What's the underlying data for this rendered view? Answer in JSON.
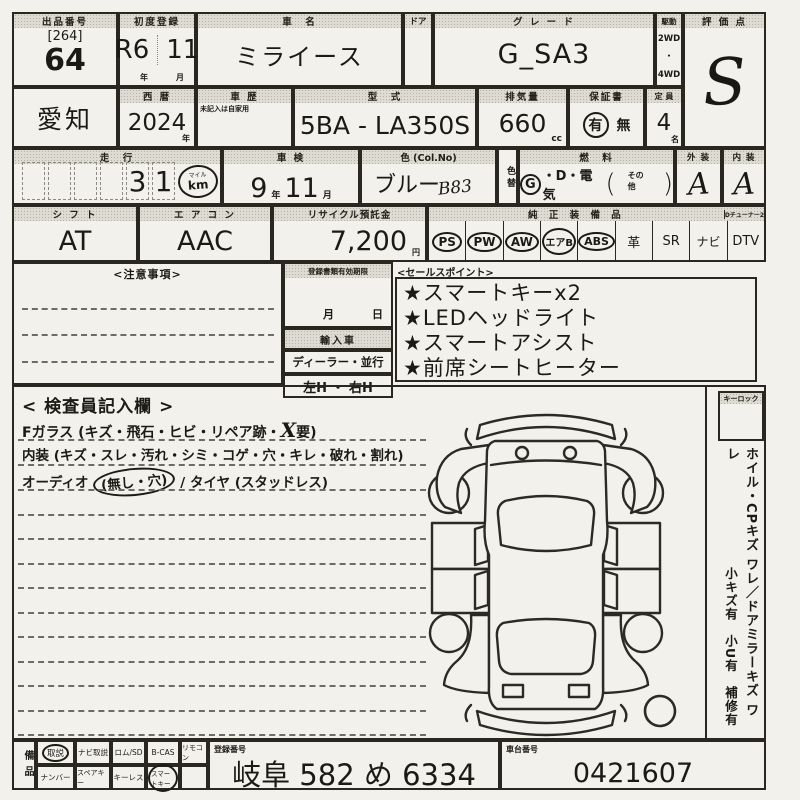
{
  "row1": {
    "lot_header": "出品番号",
    "lot_bracket": "[264]",
    "lot_number": "64",
    "first_reg_header": "初度登録",
    "first_reg_era": "R6",
    "first_reg_month": "11",
    "first_reg_year_unit": "年",
    "first_reg_month_unit": "月",
    "car_name_header": "車　名",
    "car_name": "ミライース",
    "door_header": "ドア",
    "grade_header": "グ レ ー ド",
    "grade": "G_SA3",
    "drive_header": "駆動",
    "drive_2wd": "2WD",
    "drive_dot": "・",
    "drive_4wd": "4WD",
    "score_header": "評 価 点",
    "score": "S"
  },
  "row2": {
    "region": "愛知",
    "year_header": "西 暦",
    "year": "2024",
    "year_unit": "年",
    "history_header": "車 歴",
    "history_note": "未記入は自家用",
    "model_header": "型　式",
    "model": "5BA - LA350S",
    "displacement_header": "排気量",
    "displacement": "660",
    "displacement_unit": "cc",
    "warranty_header": "保証書",
    "warranty_yes": "有",
    "warranty_no": "無",
    "capacity_header": "定 員",
    "capacity": "4",
    "capacity_unit": "名"
  },
  "row3": {
    "mileage_header": "走　行",
    "mileage_d1": "3",
    "mileage_d2": "1",
    "mileage_mile": "マイル",
    "mileage_km": "km",
    "inspection_header": "車 検",
    "inspection_year": "9",
    "inspection_year_unit": "年",
    "inspection_month": "11",
    "inspection_month_unit": "月",
    "color_header": "色 (Col.No)",
    "color": "ブルー",
    "color_code": "B83",
    "color_change": "色替",
    "fuel_header": "燃　料",
    "fuel_g": "G",
    "fuel_rest": "・D・電気",
    "fuel_paren_open": "(",
    "fuel_other": "その他",
    "fuel_paren_close": ")",
    "exterior_header": "外 装",
    "exterior": "A",
    "interior_header": "内 装",
    "interior": "A"
  },
  "row4": {
    "shift_header": "シ フ ト",
    "shift": "AT",
    "aircon_header": "エ ア コ ン",
    "aircon": "AAC",
    "recycle_header": "リサイクル預託金",
    "recycle": "7,200",
    "recycle_unit": "円",
    "equip_header": "純 正 装 備 品",
    "dtv_header": "Dチューナー2",
    "equip": [
      {
        "label": "PS"
      },
      {
        "label": "PW"
      },
      {
        "label": "AW"
      },
      {
        "label": "エアB"
      },
      {
        "label": "ABS"
      },
      {
        "label": "革"
      },
      {
        "label": "SR"
      },
      {
        "label": "ナビ"
      },
      {
        "label": "DTV"
      }
    ]
  },
  "notes": {
    "title": "<注意事項>"
  },
  "docs": {
    "validity_header": "登録書類有効期限",
    "month_unit": "月",
    "day_unit": "日",
    "import_header": "輸入車",
    "dealer": "ディーラー・並行",
    "handle": "左H ・ 右H"
  },
  "sales": {
    "title": "<セールスポイント>",
    "points": [
      "★スマートキーx2",
      "★LEDヘッドライト",
      "★スマートアシスト",
      "★前席シートヒーター"
    ]
  },
  "inspector": {
    "title": "< 検査員記入欄 >",
    "glass_prefix": "Fガラス (キズ・飛石・ヒビ・リペア跡・",
    "glass_mark": "X",
    "glass_suffix": "要)",
    "interior_line": "内装 (キズ・スレ・汚れ・シミ・コゲ・穴・キレ・破れ・割れ)",
    "audio_prefix": "オーディオ ",
    "audio_circled": "(無し・穴)",
    "audio_suffix": " / タイヤ (スタッドレス)"
  },
  "sidebar": {
    "keylock_header": "キーロック",
    "note1": "ホイル・CPキズ ワレ／ドアミラーキズ ワレ",
    "note2": "小キズ有　小U有　補修有"
  },
  "bottom": {
    "equip_label": "備品",
    "row1": [
      {
        "label": "取説"
      },
      {
        "label": "ナビ取説"
      },
      {
        "label": "ロム/SD"
      },
      {
        "label": "B-CAS"
      },
      {
        "label": "リモコン"
      }
    ],
    "row2": [
      {
        "label": "ナンバー"
      },
      {
        "label": "スペアキー"
      },
      {
        "label": "キーレス"
      },
      {
        "label": "スマートキー"
      },
      {
        "label": ""
      }
    ],
    "reg_header": "登録番号",
    "reg_number": "岐阜 582 め 6334",
    "chassis_header": "車台番号",
    "chassis_number": "0421607"
  }
}
